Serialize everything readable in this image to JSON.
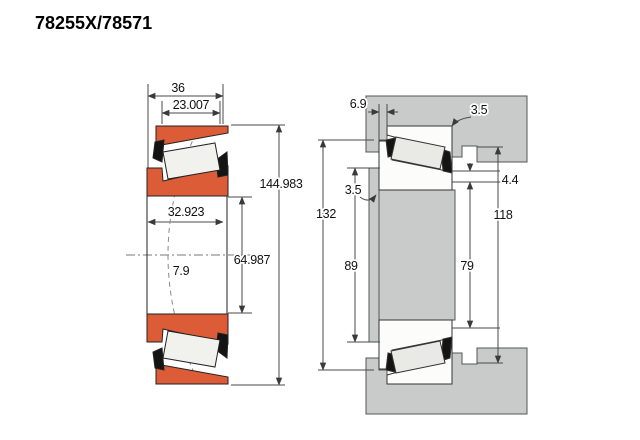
{
  "title": "78255X/78571",
  "colors": {
    "bearing_orange": "#dd5c38",
    "roller_light": "#f1f1ee",
    "roller_right": "#e9e9e6",
    "cage_black": "#141414",
    "steel_gray": "#c9cbcb",
    "white_part": "#fcfcfb",
    "outline": "#222222",
    "dim_line": "#4a4a4a"
  },
  "left_view": {
    "label": "bearing cross-section view",
    "dims": {
      "overall_width": "36",
      "cup_width": "23.007",
      "outer_diameter": "144.983",
      "cone_width": "32.923",
      "bore_diameter": "64.987",
      "load_center": "7.9"
    }
  },
  "right_view": {
    "label": "shaft and housing mounting view",
    "dims": {
      "backface_standout": "6.9",
      "housing_fillet_radius": "3.5",
      "shaft_fillet_radius": "3.5",
      "housing_face_diameter": "132",
      "shaft_shoulder_diameter": "89",
      "cone_rib_diameter": "79",
      "housing_shoulder_diameter": "118",
      "shoulder_clearance": "4.4"
    }
  }
}
